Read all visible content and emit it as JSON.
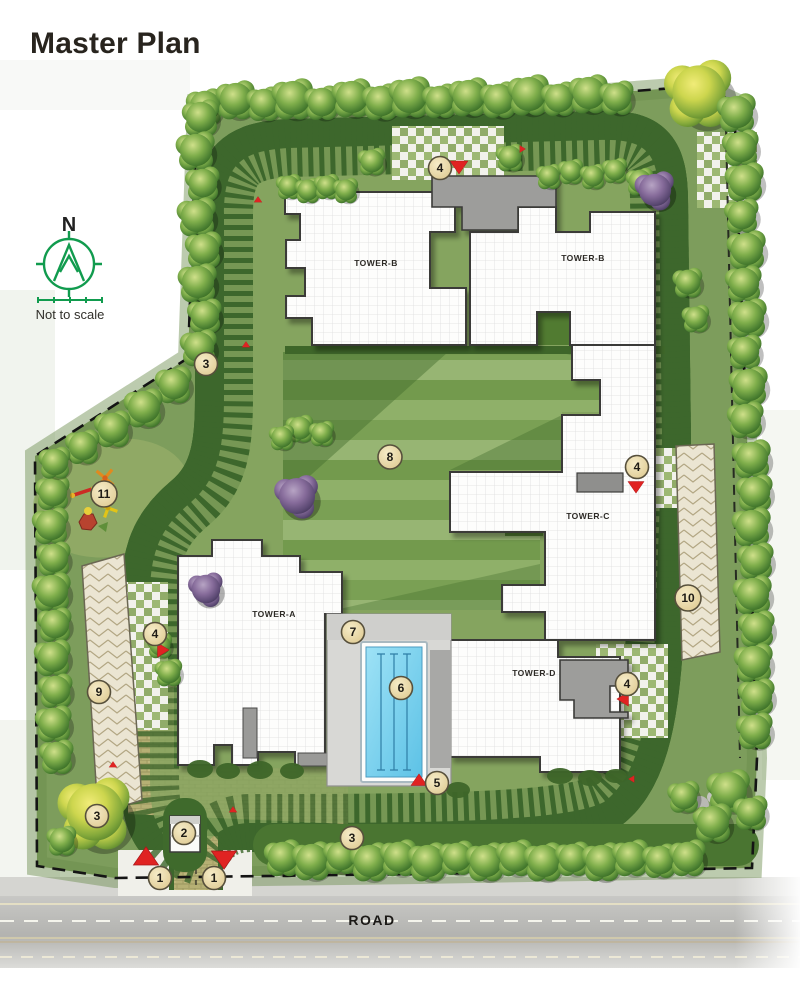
{
  "page": {
    "title": "Master Plan"
  },
  "compass": {
    "direction_label": "N",
    "note": "Not to scale",
    "accent_color": "#119b4e"
  },
  "road": {
    "label": "ROAD"
  },
  "towers": [
    {
      "label": "TOWER-B"
    },
    {
      "label": "TOWER-B"
    },
    {
      "label": "TOWER-C"
    },
    {
      "label": "TOWER-A"
    },
    {
      "label": "TOWER-D"
    }
  ],
  "markers": [
    {
      "label": "4"
    },
    {
      "label": "4"
    },
    {
      "label": "4"
    },
    {
      "label": "4"
    },
    {
      "label": "8"
    },
    {
      "label": "11"
    },
    {
      "label": "9"
    },
    {
      "label": "10"
    },
    {
      "label": "7"
    },
    {
      "label": "6"
    },
    {
      "label": "5"
    },
    {
      "label": "3"
    },
    {
      "label": "3"
    },
    {
      "label": "3"
    },
    {
      "label": "2"
    },
    {
      "label": "1"
    },
    {
      "label": "1"
    }
  ],
  "colors": {
    "site_green": "#7d9d5c",
    "lawn_stripe": "#8fb069",
    "paver_tan": "#b9b275",
    "hedge_dark": "#3d672c",
    "pool_blue": "#63c6e8",
    "marker_fill": "#ecd9a6",
    "arrow_red": "#e02322",
    "boundary_black": "#141414"
  }
}
